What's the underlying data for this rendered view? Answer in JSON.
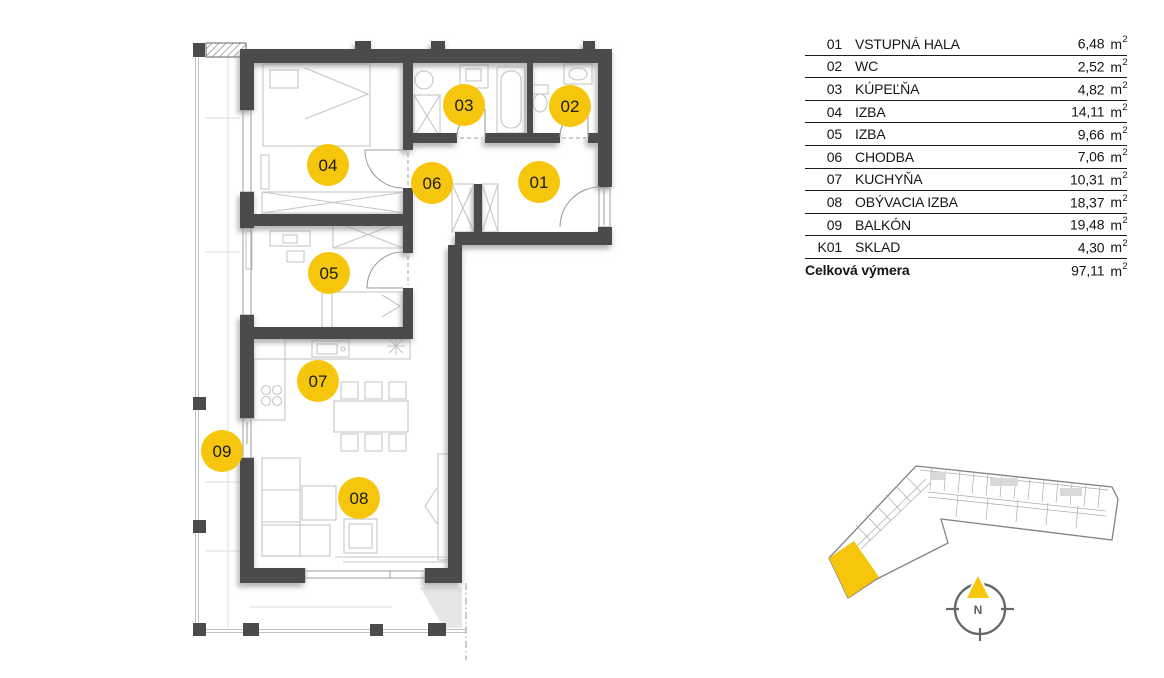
{
  "colors": {
    "accent": "#F5C60B",
    "wall": "#4A4B4D"
  },
  "legend": {
    "unit": "m",
    "unit_sup": "2",
    "rows": [
      {
        "code": "01",
        "name": "VSTUPNÁ HALA",
        "area": "6,48"
      },
      {
        "code": "02",
        "name": "WC",
        "area": "2,52"
      },
      {
        "code": "03",
        "name": "KÚPEĽŇA",
        "area": "4,82"
      },
      {
        "code": "04",
        "name": "IZBA",
        "area": "14,11"
      },
      {
        "code": "05",
        "name": "IZBA",
        "area": "9,66"
      },
      {
        "code": "06",
        "name": "CHODBA",
        "area": "7,06"
      },
      {
        "code": "07",
        "name": "KUCHYŇA",
        "area": "10,31"
      },
      {
        "code": "08",
        "name": "OBÝVACIA IZBA",
        "area": "18,37"
      },
      {
        "code": "09",
        "name": "BALKÓN",
        "area": "19,48"
      },
      {
        "code": "K01",
        "name": "SKLAD",
        "area": "4,30"
      }
    ],
    "total": {
      "label": "Celková výmera",
      "area": "97,11"
    }
  },
  "plan": {
    "labels": [
      "01",
      "02",
      "03",
      "04",
      "05",
      "06",
      "07",
      "08",
      "09"
    ]
  },
  "compass": {
    "north_label": "N"
  }
}
